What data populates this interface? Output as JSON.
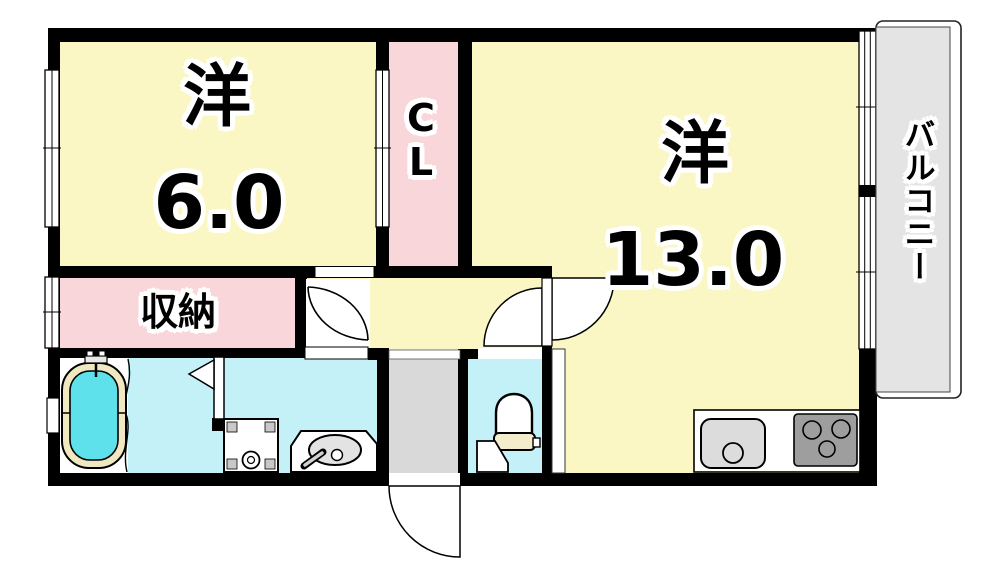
{
  "rooms": {
    "western6": {
      "name": "洋",
      "area": "6.0"
    },
    "western13": {
      "name": "洋",
      "area": "13.0"
    },
    "closet": {
      "label": "CL"
    },
    "storage": {
      "label": "収納"
    },
    "balcony": {
      "label": "バルコニー"
    }
  },
  "colors": {
    "wall": "#000000",
    "room_yellow": "#FBF7C4",
    "pink": "#F9D6DA",
    "cyan": "#C4F1F7",
    "entry_gray": "#D9D9D9",
    "balcony_gray": "#E4E4E4",
    "tub_water": "#5FE1EC",
    "tub_rim": "#EFE8C0",
    "tank_cream": "#F3EDCB",
    "stove_gray": "#9E9E9E",
    "sink_gray": "#DCDCDC",
    "basin_gray": "#E3E3E3",
    "door_white": "#FFFFFF"
  },
  "fixtures": {
    "bathtub": "bathtub",
    "washer_pan": "washing-machine-pan",
    "vanity": "vanity-sink",
    "toilet": "toilet",
    "kitchen_sink": "kitchen-sink",
    "stove": "gas-stove",
    "entrance_door": "entrance-door"
  }
}
